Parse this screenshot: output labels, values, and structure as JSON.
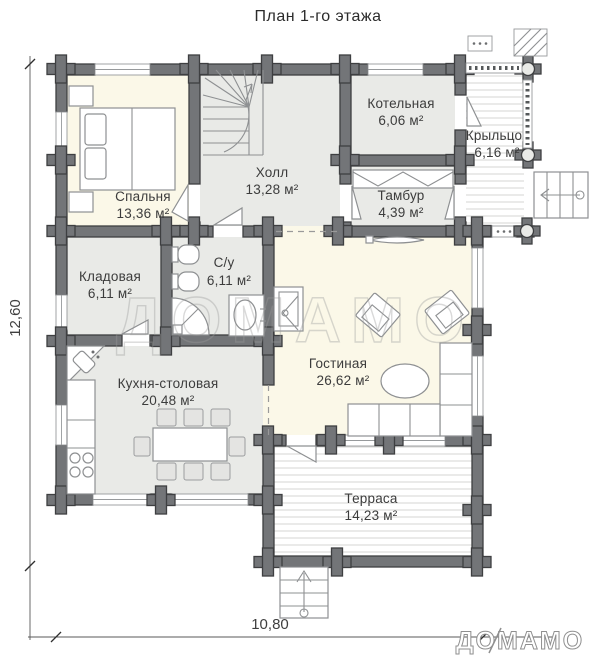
{
  "title": "План 1-го этажа",
  "rooms": [
    {
      "name": "Спальня",
      "area": "13,36 м²"
    },
    {
      "name": "Холл",
      "area": "13,28 м²"
    },
    {
      "name": "Котельная",
      "area": "6,06 м²"
    },
    {
      "name": "Крыльцо",
      "area": "6,16 м²"
    },
    {
      "name": "Тамбур",
      "area": "4,39 м²"
    },
    {
      "name": "Кладовая",
      "area": "6,11 м²"
    },
    {
      "name": "С/у",
      "area": "6,11 м²"
    },
    {
      "name": "Гостиная",
      "area": "26,62 м²"
    },
    {
      "name": "Кухня-столовая",
      "area": "20,48 м²"
    },
    {
      "name": "Терраса",
      "area": "14,23 м²"
    }
  ],
  "dimensions": {
    "width": "10,80",
    "height": "12,60"
  },
  "watermark": "ДОМАМО",
  "logo": "ДОМАМО",
  "colors": {
    "wall": "#737578",
    "wall_outline": "#3e3f41",
    "floor_warm": "#fbf8e8",
    "floor_gray": "#e9eae7",
    "deck_line": "#d5d6d3",
    "label_text": "#3c3c3c"
  }
}
